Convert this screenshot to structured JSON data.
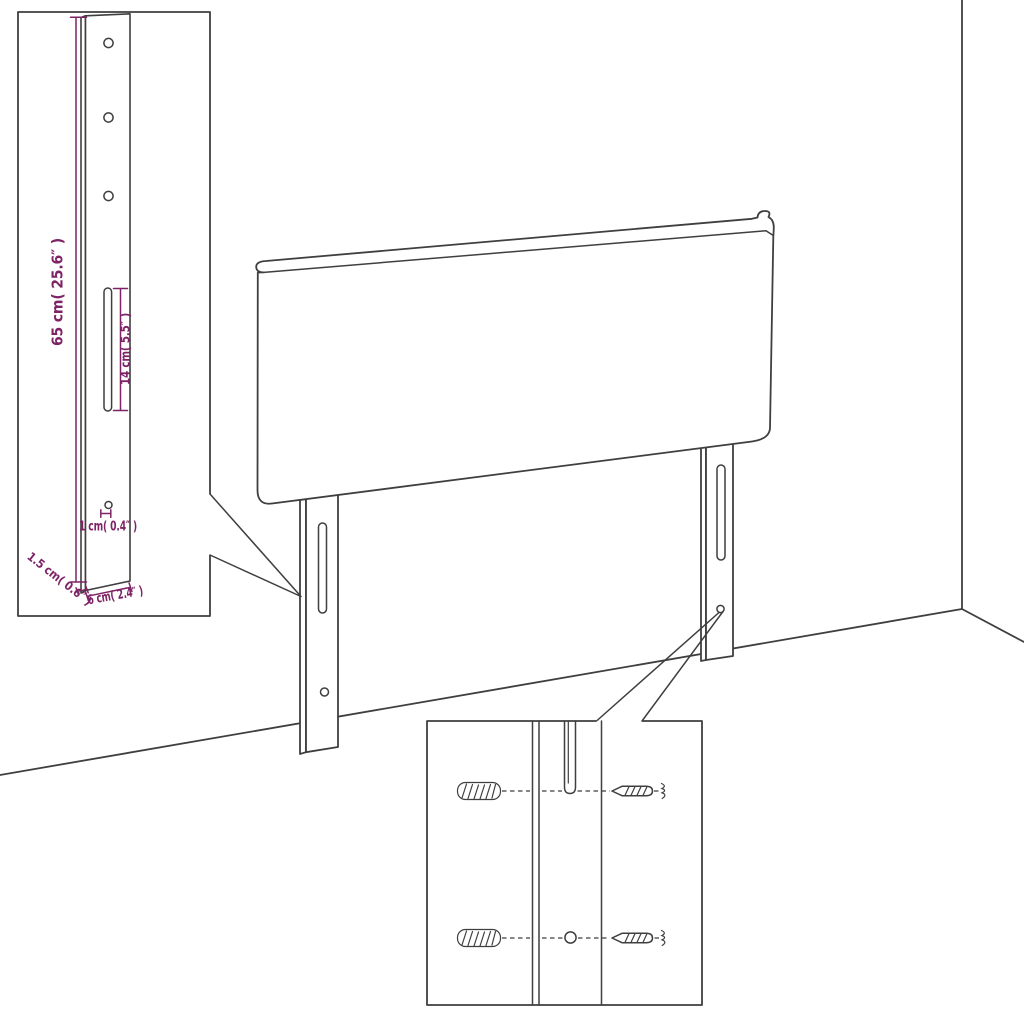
{
  "diagram": {
    "subject": "headboard-assembly-diagram",
    "colors": {
      "line_color": "#3f3f3f",
      "dimension_color": "#7e2466",
      "background": "#ffffff"
    },
    "dimensions": {
      "height": "65 cm( 25.6″ )",
      "slot_length": "14 cm( 5.5″ )",
      "hole_diameter": "1 cm( 0.4″ )",
      "thickness": "1.5 cm( 0.6″ )",
      "leg_width": "6 cm( 2.4″ )"
    },
    "parts": [
      "headboard-panel",
      "mounting-leg",
      "mounting-slot",
      "mounting-hole",
      "wall-plug",
      "screw"
    ]
  }
}
